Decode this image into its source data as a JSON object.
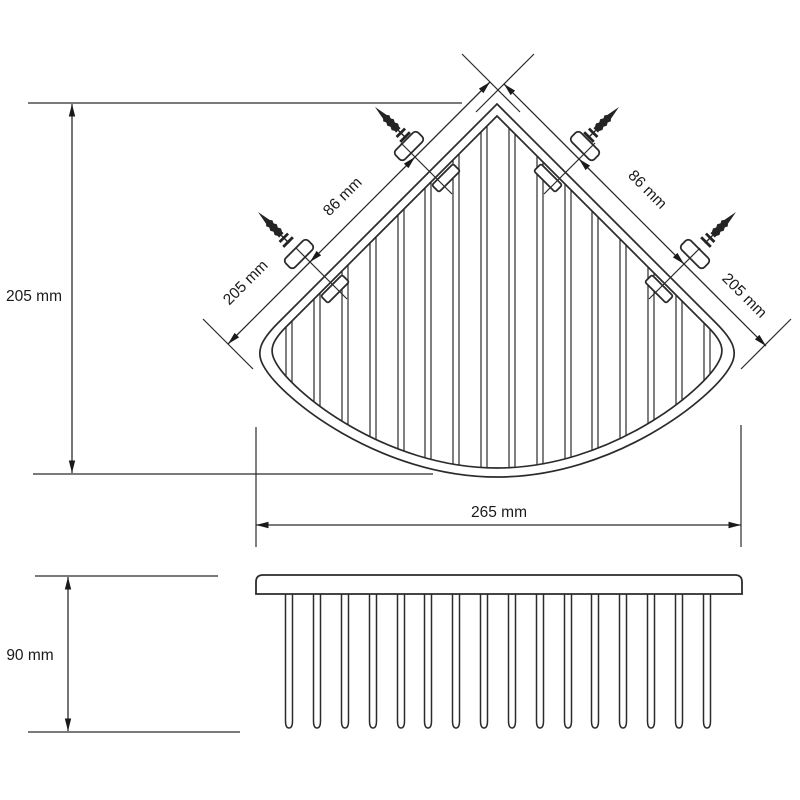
{
  "page": {
    "background": "#ffffff"
  },
  "colors": {
    "line": "#2b2b2b",
    "ref_line": "#4f4f4f",
    "text": "#1a1a1a"
  },
  "dimensions": {
    "depth": "205 mm",
    "left_rail_length": "205 mm",
    "right_rail_length": "205 mm",
    "left_screw_spacing": "86 mm",
    "right_screw_spacing": "86 mm",
    "front_width": "265 mm",
    "height": "90 mm"
  }
}
